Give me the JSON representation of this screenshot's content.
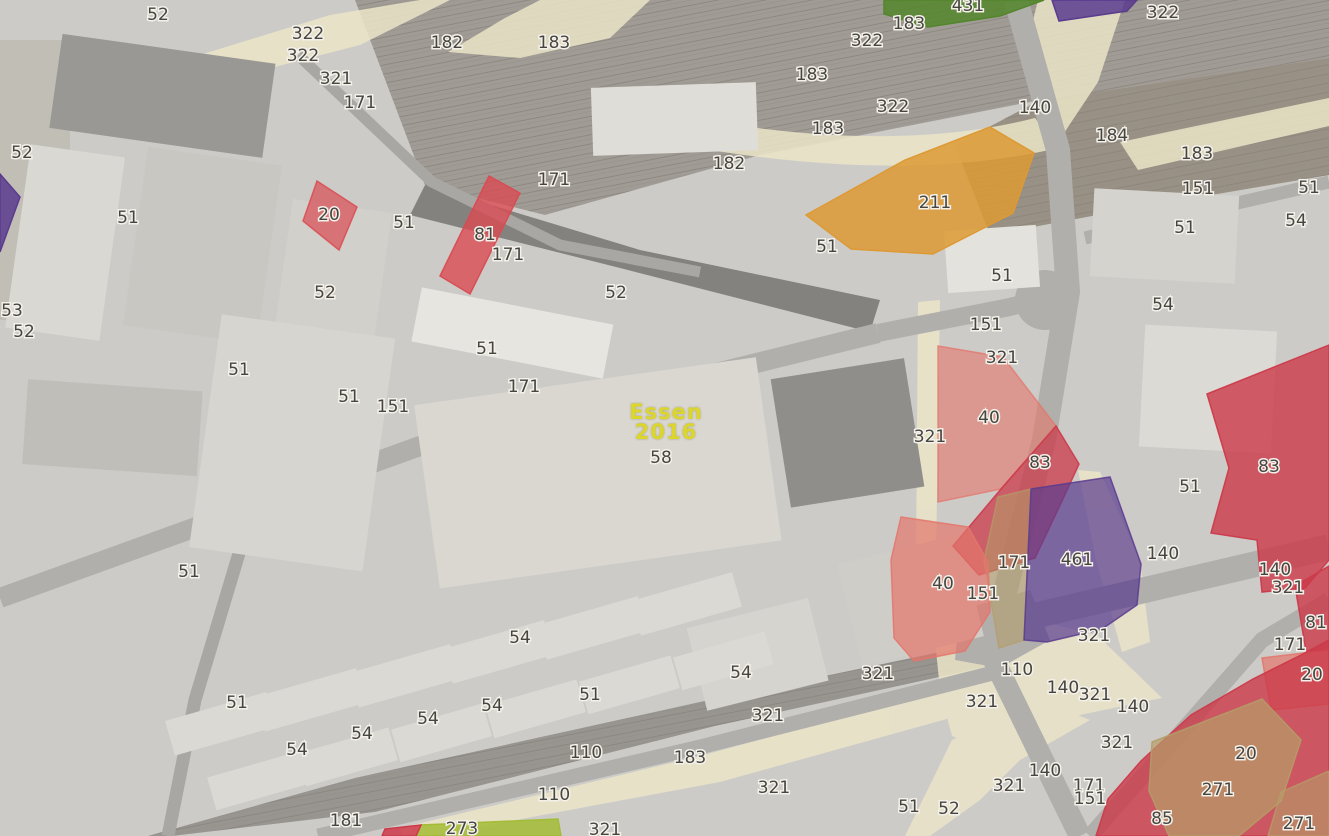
{
  "map": {
    "watermark": {
      "line1": "Essen",
      "line2": "2016",
      "color": "#dcd62a"
    },
    "palette": {
      "red": "#cc3a4a",
      "red2": "#d94b52",
      "salmon": "#e4766b",
      "orange": "#dd9a34",
      "purple": "#5a3b8e",
      "green": "#53862c",
      "olive": "#a3bc35",
      "khaki": "#b59d67",
      "cream": "#e9e2c1",
      "label_text": "#474540",
      "label_halo": "#f4f1ea"
    },
    "parcels": [
      {
        "code": "",
        "name": "purple-wedge-west",
        "color": "purple",
        "opacity": 0.85,
        "points": "0,174 20,197 0,252"
      },
      {
        "code": "20",
        "name": "parcel-20-west",
        "color": "red2",
        "opacity": 0.7,
        "points": "317,181 357,207 339,250 303,221"
      },
      {
        "code": "81",
        "name": "parcel-81-west",
        "color": "red2",
        "opacity": 0.8,
        "points": "489,176 520,193 470,294 440,276"
      },
      {
        "code": "211",
        "name": "parcel-211",
        "color": "orange",
        "opacity": 0.85,
        "points": "806,215 905,160 990,127 1034,153 1013,213 933,254 851,249"
      },
      {
        "code": "431",
        "name": "parcel-431",
        "color": "green",
        "opacity": 0.85,
        "points": "884,0 1044,0 1000,16 928,27 884,14"
      },
      {
        "code": "",
        "name": "purple-band-north",
        "color": "purple",
        "opacity": 0.85,
        "points": "1052,0 1137,0 1127,11 1059,21"
      },
      {
        "code": "40",
        "name": "parcel-40-north",
        "color": "salmon",
        "opacity": 0.6,
        "points": "938,346 1003,357 1056,426 1001,489 938,502"
      },
      {
        "code": "83",
        "name": "parcel-83-west",
        "color": "red",
        "opacity": 0.75,
        "points": "1056,426 1079,464 1062,501 1035,558 979,575 953,546 1001,489"
      },
      {
        "code": "",
        "name": "khaki-lot",
        "color": "khaki",
        "opacity": 0.55,
        "points": "998,497 1031,489 1024,640 999,648 984,560"
      },
      {
        "code": "461",
        "name": "parcel-461",
        "color": "purple",
        "opacity": 0.7,
        "points": "1031,489 1110,477 1141,564 1137,605 1102,629 1047,642 1024,640"
      },
      {
        "code": "40",
        "name": "parcel-40-south",
        "color": "salmon",
        "opacity": 0.7,
        "points": "901,517 968,527 988,562 990,612 965,651 914,661 894,638 891,560"
      },
      {
        "code": "83",
        "name": "parcel-83-east",
        "color": "red",
        "opacity": 0.8,
        "points": "1207,394 1329,345 1329,560 1305,588 1262,592 1257,540 1211,533 1229,468"
      },
      {
        "code": "81",
        "name": "parcel-81-east",
        "color": "red",
        "opacity": 0.8,
        "points": "1295,586 1329,566 1329,650 1306,651"
      },
      {
        "code": "20",
        "name": "parcel-20-east",
        "color": "salmon",
        "opacity": 0.7,
        "points": "1262,658 1329,650 1329,704 1271,710"
      },
      {
        "code": "271",
        "name": "parcel-271-complex",
        "color": "red",
        "opacity": 0.8,
        "points": "1329,640 1329,836 1096,836 1108,799 1141,761 1191,715 1253,679 1301,655"
      },
      {
        "code": "271",
        "name": "sand-lot-271",
        "color": "khaki",
        "opacity": 0.7,
        "points": "1152,742 1262,699 1301,740 1281,801 1239,836 1169,836 1149,791"
      },
      {
        "code": "",
        "name": "sand-lot-east",
        "color": "khaki",
        "opacity": 0.6,
        "points": "1281,792 1329,771 1329,836 1268,836"
      },
      {
        "code": "273",
        "name": "parcel-273",
        "color": "olive",
        "opacity": 0.85,
        "points": "421,825 558,819 561,836 416,836"
      },
      {
        "code": "",
        "name": "red-sliver-south",
        "color": "red",
        "opacity": 0.85,
        "points": "385,829 421,825 416,836 382,836"
      }
    ],
    "labels": [
      {
        "t": "52",
        "x": 158,
        "y": 15
      },
      {
        "t": "322",
        "x": 308,
        "y": 34
      },
      {
        "t": "322",
        "x": 303,
        "y": 56
      },
      {
        "t": "321",
        "x": 336,
        "y": 79
      },
      {
        "t": "171",
        "x": 360,
        "y": 103
      },
      {
        "t": "182",
        "x": 447,
        "y": 43
      },
      {
        "t": "183",
        "x": 554,
        "y": 43
      },
      {
        "t": "322",
        "x": 867,
        "y": 41
      },
      {
        "t": "183",
        "x": 812,
        "y": 75
      },
      {
        "t": "322",
        "x": 893,
        "y": 107
      },
      {
        "t": "183",
        "x": 828,
        "y": 129
      },
      {
        "t": "182",
        "x": 729,
        "y": 164
      },
      {
        "t": "171",
        "x": 554,
        "y": 180
      },
      {
        "t": "431",
        "x": 968,
        "y": 6
      },
      {
        "t": "322",
        "x": 1163,
        "y": 13
      },
      {
        "t": "183",
        "x": 909,
        "y": 24
      },
      {
        "t": "140",
        "x": 1035,
        "y": 108
      },
      {
        "t": "184",
        "x": 1112,
        "y": 136
      },
      {
        "t": "183",
        "x": 1197,
        "y": 154
      },
      {
        "t": "151",
        "x": 1198,
        "y": 189
      },
      {
        "t": "51",
        "x": 1309,
        "y": 188
      },
      {
        "t": "54",
        "x": 1296,
        "y": 221
      },
      {
        "t": "51",
        "x": 1185,
        "y": 228
      },
      {
        "t": "211",
        "x": 935,
        "y": 203
      },
      {
        "t": "51",
        "x": 1002,
        "y": 276
      },
      {
        "t": "52",
        "x": 22,
        "y": 153
      },
      {
        "t": "51",
        "x": 128,
        "y": 218
      },
      {
        "t": "20",
        "x": 329,
        "y": 215
      },
      {
        "t": "51",
        "x": 404,
        "y": 223
      },
      {
        "t": "81",
        "x": 485,
        "y": 235
      },
      {
        "t": "171",
        "x": 508,
        "y": 255
      },
      {
        "t": "51",
        "x": 827,
        "y": 247
      },
      {
        "t": "52",
        "x": 616,
        "y": 293
      },
      {
        "t": "53",
        "x": 12,
        "y": 311
      },
      {
        "t": "52",
        "x": 24,
        "y": 332
      },
      {
        "t": "52",
        "x": 325,
        "y": 293
      },
      {
        "t": "51",
        "x": 239,
        "y": 370
      },
      {
        "t": "51",
        "x": 349,
        "y": 397
      },
      {
        "t": "151",
        "x": 393,
        "y": 407
      },
      {
        "t": "51",
        "x": 487,
        "y": 349
      },
      {
        "t": "171",
        "x": 524,
        "y": 387
      },
      {
        "t": "58",
        "x": 661,
        "y": 458
      },
      {
        "t": "54",
        "x": 1163,
        "y": 305
      },
      {
        "t": "151",
        "x": 986,
        "y": 325
      },
      {
        "t": "321",
        "x": 1002,
        "y": 358
      },
      {
        "t": "40",
        "x": 989,
        "y": 418
      },
      {
        "t": "321",
        "x": 930,
        "y": 437
      },
      {
        "t": "83",
        "x": 1040,
        "y": 463
      },
      {
        "t": "83",
        "x": 1269,
        "y": 467
      },
      {
        "t": "51",
        "x": 1190,
        "y": 487
      },
      {
        "t": "461",
        "x": 1077,
        "y": 560
      },
      {
        "t": "171",
        "x": 1014,
        "y": 563
      },
      {
        "t": "140",
        "x": 1163,
        "y": 554
      },
      {
        "t": "140",
        "x": 1275,
        "y": 570
      },
      {
        "t": "40",
        "x": 943,
        "y": 584
      },
      {
        "t": "151",
        "x": 983,
        "y": 594
      },
      {
        "t": "321",
        "x": 1288,
        "y": 588
      },
      {
        "t": "51",
        "x": 189,
        "y": 572
      },
      {
        "t": "51",
        "x": 237,
        "y": 703
      },
      {
        "t": "54",
        "x": 297,
        "y": 750
      },
      {
        "t": "54",
        "x": 362,
        "y": 734
      },
      {
        "t": "54",
        "x": 428,
        "y": 719
      },
      {
        "t": "181",
        "x": 346,
        "y": 821
      },
      {
        "t": "54",
        "x": 520,
        "y": 638
      },
      {
        "t": "54",
        "x": 492,
        "y": 706
      },
      {
        "t": "51",
        "x": 590,
        "y": 695
      },
      {
        "t": "54",
        "x": 741,
        "y": 673
      },
      {
        "t": "321",
        "x": 768,
        "y": 716
      },
      {
        "t": "110",
        "x": 586,
        "y": 753
      },
      {
        "t": "183",
        "x": 690,
        "y": 758
      },
      {
        "t": "110",
        "x": 554,
        "y": 795
      },
      {
        "t": "321",
        "x": 774,
        "y": 788
      },
      {
        "t": "273",
        "x": 462,
        "y": 829
      },
      {
        "t": "321",
        "x": 605,
        "y": 830
      },
      {
        "t": "321",
        "x": 878,
        "y": 674
      },
      {
        "t": "81",
        "x": 1316,
        "y": 623
      },
      {
        "t": "171",
        "x": 1290,
        "y": 645
      },
      {
        "t": "20",
        "x": 1312,
        "y": 675
      },
      {
        "t": "321",
        "x": 1094,
        "y": 636
      },
      {
        "t": "110",
        "x": 1017,
        "y": 670
      },
      {
        "t": "140",
        "x": 1063,
        "y": 688
      },
      {
        "t": "321",
        "x": 1095,
        "y": 695
      },
      {
        "t": "140",
        "x": 1133,
        "y": 707
      },
      {
        "t": "321",
        "x": 982,
        "y": 702
      },
      {
        "t": "321",
        "x": 1117,
        "y": 743
      },
      {
        "t": "140",
        "x": 1045,
        "y": 771
      },
      {
        "t": "321",
        "x": 1009,
        "y": 786
      },
      {
        "t": "171",
        "x": 1089,
        "y": 786
      },
      {
        "t": "151",
        "x": 1090,
        "y": 799
      },
      {
        "t": "51",
        "x": 909,
        "y": 807
      },
      {
        "t": "52",
        "x": 949,
        "y": 809
      },
      {
        "t": "85",
        "x": 1162,
        "y": 819
      },
      {
        "t": "271",
        "x": 1218,
        "y": 790
      },
      {
        "t": "20",
        "x": 1246,
        "y": 754
      },
      {
        "t": "271",
        "x": 1299,
        "y": 824
      }
    ]
  }
}
